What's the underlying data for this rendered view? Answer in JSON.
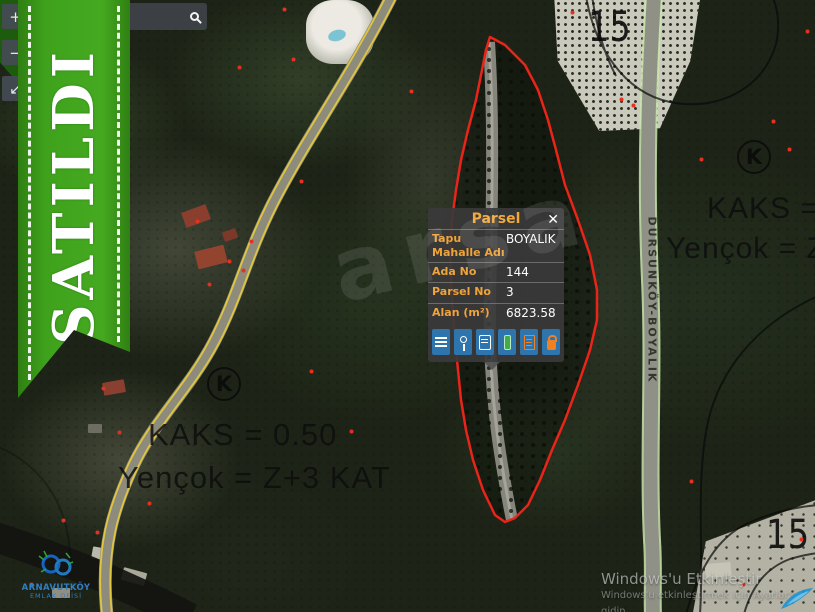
{
  "banner": {
    "label": "SATILDI",
    "color": "#3fa21c"
  },
  "map_controls": {
    "zoom_in": "+",
    "zoom_out": "−",
    "pan": "↙"
  },
  "search": {
    "value": ""
  },
  "popup": {
    "title": "Parsel",
    "close": "✕",
    "accent_color": "#efa33b",
    "rows": [
      {
        "label": "Tapu Mahalle Adı",
        "value": "BOYALIK"
      },
      {
        "label": "Ada No",
        "value": "144"
      },
      {
        "label": "Parsel No",
        "value": "3"
      },
      {
        "label": "Alan (m²)",
        "value": "6823.58"
      }
    ],
    "toolbar_icons": [
      "list-icon",
      "pin-icon",
      "seal-icon",
      "measure-icon",
      "report-icon",
      "lock-icon"
    ]
  },
  "annotations": {
    "zoning_left_line1": "KAKS = 0.50",
    "zoning_left_line2": "Yençok = Z+3 KAT",
    "zoning_right_line1": "KAKS = 0.",
    "zoning_right_line2": "Yençok = Z+3",
    "k_symbol": "K",
    "number_top": "15",
    "number_bottom_right": "15",
    "road_label_right": "DURSUNKÖY-BOYALIK",
    "parcel_outline_color": "#ea2418",
    "photo_watermark": "arsa"
  },
  "windows_watermark": {
    "line1": "Windows'u Etkinleştir",
    "line2": "Windows'u etkinleştirmek için Ayarlar'a gidin."
  },
  "logo": {
    "line1": "ARNAVUTKÖY",
    "line2": "EMLAK OFİSİ"
  }
}
